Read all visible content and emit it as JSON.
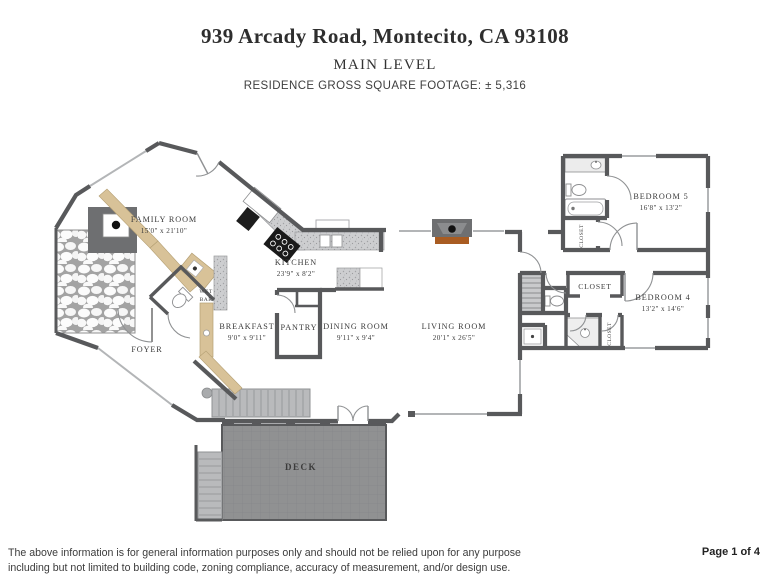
{
  "header": {
    "address": "939 Arcady Road, Montecito, CA 93108",
    "level": "MAIN LEVEL",
    "sqft_line": "RESIDENCE GROSS SQUARE FOOTAGE: ± 5,316"
  },
  "rooms": {
    "family_room": {
      "name": "FAMILY ROOM",
      "dims": "15'0\" x 21'10\""
    },
    "kitchen": {
      "name": "KITCHEN",
      "dims": "23'9\" x 8'2\""
    },
    "wet_bar": {
      "line1": "WET",
      "line2": "BAR"
    },
    "breakfast": {
      "name": "BREAKFAST",
      "dims": "9'0\" x 9'11\""
    },
    "pantry": {
      "name": "PANTRY"
    },
    "dining_room": {
      "name": "DINING ROOM",
      "dims": "9'11\" x 9'4\""
    },
    "living_room": {
      "name": "LIVING ROOM",
      "dims": "20'1\" x 26'5\""
    },
    "foyer": {
      "name": "FOYER"
    },
    "bedroom_5": {
      "name": "BEDROOM 5",
      "dims": "16'8\" x 13'2\""
    },
    "bedroom_4": {
      "name": "BEDROOM 4",
      "dims": "13'2\" x 14'6\""
    },
    "closet_bed5": {
      "name": "CLOSET"
    },
    "closet_hall": {
      "name": "CLOSET"
    },
    "closet_bed4": {
      "name": "CLOSET"
    },
    "deck": {
      "name": "DECK"
    }
  },
  "footer": {
    "disclaimer_line1": "The above information is for general information purposes only and should not be relied upon for any purpose",
    "disclaimer_line2": "including but not limited to building code,  zoning compliance, accuracy of measurement, and/or design use.",
    "page_label": "Page 1 of 4"
  },
  "colors": {
    "wall": "#58595b",
    "counter_speckle": "#cbccce",
    "wood_beige": "#d8c298",
    "hearth_brown": "#a95c22",
    "deck_gray": "#909192",
    "stair_gray": "#b9babc",
    "text": "#3b3b3b"
  }
}
